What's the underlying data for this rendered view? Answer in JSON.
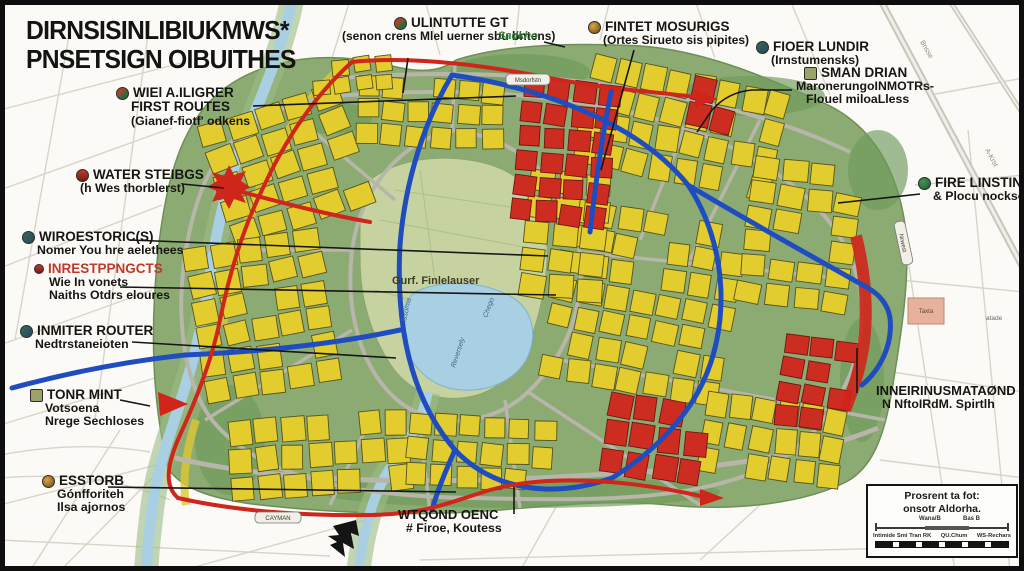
{
  "title": {
    "line1": "DIRNSISINLIBIUKMWS*",
    "line2": "PNSETSIGN OIBUITHES"
  },
  "labels": {
    "wiel": {
      "l1": "WIEl A.ILIGRER",
      "l2": "FIRST ROUTES",
      "l3": "(Gianef-fiotf' odkens"
    },
    "water_steibgs": {
      "l1": "WATER STEIBGS",
      "l2": "(h Wes thorblerst)"
    },
    "wiroestorics": {
      "l1": "WIROESTORIC(S)",
      "l2": "Nomer You hre aelethees"
    },
    "inrestppngcts": {
      "l1": "INRESTPPNGCTS",
      "l2": "Wie In vonets",
      "l3": "Naiths Otdrs eloures"
    },
    "inmiter": {
      "l1": "INMITER ROUTER",
      "l2": "Nedtrstaneioten"
    },
    "tonr": {
      "l1": "TONR MINT",
      "l2": "Votsoena",
      "l3": "Nrege Sechloses"
    },
    "esstorb": {
      "l1": "ESSTORB",
      "l2": "Gónfforiteh",
      "l3": "Ilsa ajornos"
    },
    "ulintutte": {
      "l1": "ULINTUTTE GT",
      "l2": "(senon crens Mlel uerner sbu bntens)"
    },
    "sadkho": {
      "l1": "Sadkho"
    },
    "fintet": {
      "l1": "FINTET MOSURIGS",
      "l2": "(Ortes Sirueto sis pipites)"
    },
    "fioer": {
      "l1": "FIOER LUNDIR",
      "l2": "(Irnstumensks)"
    },
    "sman": {
      "l1": "SMAN DRIAN",
      "l2": "MaronerungoINMOTRs-",
      "l3": "Flouel miloaLless"
    },
    "fire_linsin": {
      "l1": "FIRE LINSTIN",
      "l2": "& Plocu nockso)"
    },
    "inneirinus": {
      "l1": "INNEIRINUSMATAØND",
      "l2": "N NftoIRdM. Spirtlh"
    },
    "wtqond": {
      "l1": "WTQOND OENC",
      "l2": "# Firoe, Koutess"
    }
  },
  "map_texts": {
    "park": "Gurf. Finlelauser",
    "water_a": "Issomia",
    "water_b": "Chego",
    "water_c": "Reversely",
    "capsule_a": "Msdorfstn",
    "capsule_b": "CAYMAN",
    "capsule_c": "Nrwest",
    "hw_a": "Bnsse",
    "hw_b": "A-Krst",
    "pink_bldg": "Taxta",
    "pink_note": "atade"
  },
  "legend": {
    "title1": "Prosrent ta fot:",
    "title2": "onsotr Aldorha.",
    "tick_a": "Wana/B",
    "tick_b": "Bas B",
    "item1": "Intimide Smi Tran RK",
    "item2": "QU.Chum",
    "item3": "WS-Rechars"
  },
  "map": {
    "colors": {
      "cityGreen": "#8cab72",
      "parkGreen": "#c6d3a0",
      "blockYellow": "#e3cc2e",
      "blockRed": "#cc2d20",
      "routeBlue": "#1f4dbf",
      "routeRed": "#cf251a",
      "water": "#a9cfe3",
      "road": "#b8b5aa",
      "accentRedText": "#c0392b",
      "greenText": "#2e7d32"
    }
  }
}
